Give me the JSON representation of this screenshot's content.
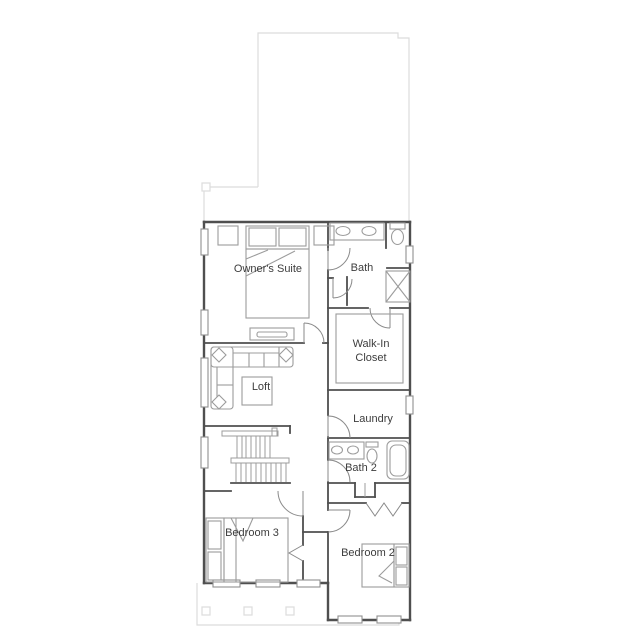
{
  "canvas": {
    "width": 639,
    "height": 639,
    "background": "#ffffff"
  },
  "colors": {
    "wall": "#4f4f4f",
    "fixture": "#9c9c9c",
    "door": "#8a8a8a",
    "light": "#dcdcdc",
    "label": "#3d3d3d",
    "bg": "#ffffff"
  },
  "floor_plan": {
    "type": "residential-second-floor-plan",
    "labels": [
      {
        "id": "owners-suite",
        "text": "Owner's Suite"
      },
      {
        "id": "bath",
        "text": "Bath"
      },
      {
        "id": "walk-in-closet-line1",
        "text": "Walk-In"
      },
      {
        "id": "walk-in-closet-line2",
        "text": "Closet"
      },
      {
        "id": "loft",
        "text": "Loft"
      },
      {
        "id": "laundry",
        "text": "Laundry"
      },
      {
        "id": "bath-2",
        "text": "Bath 2"
      },
      {
        "id": "bedroom-3",
        "text": "Bedroom 3"
      },
      {
        "id": "bedroom-2",
        "text": "Bedroom 2"
      }
    ],
    "fixtures": [
      "king-bed",
      "nightstands",
      "double-sink-vanity",
      "toilet",
      "walk-in-shower",
      "closet-shelving",
      "tv-console",
      "sectional-sofa",
      "coffee-table",
      "switchback-staircase",
      "single-sink-vanity",
      "bathtub",
      "linen-closet",
      "bifold-closet-doors",
      "beds",
      "windows",
      "door-swings",
      "porch-posts",
      "roof-outline"
    ]
  }
}
